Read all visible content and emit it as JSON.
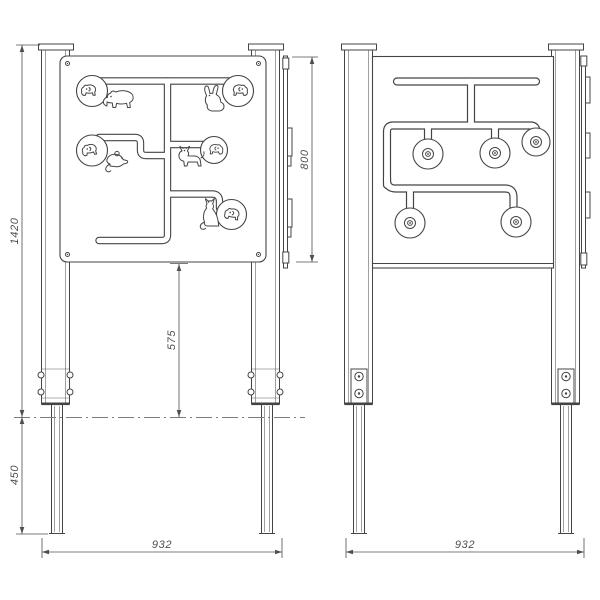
{
  "page": {
    "background": "#ffffff"
  },
  "drawing": {
    "type": "technical-drawing",
    "subject": "play panel animal maze - front and back elevation",
    "line_color": "#444444",
    "dim_color": "#4f4f4f",
    "dims": {
      "total_height": "1420",
      "panel_height": "800",
      "panel_bottom_to_ground": "575",
      "embed_depth": "450",
      "width_front": "932",
      "width_back": "932"
    },
    "front_view": {
      "animals": [
        "bear",
        "rabbit",
        "mouse",
        "cat",
        "fox"
      ],
      "slider_knobs": 5
    },
    "back_view": {
      "slider_knobs": 5
    }
  }
}
